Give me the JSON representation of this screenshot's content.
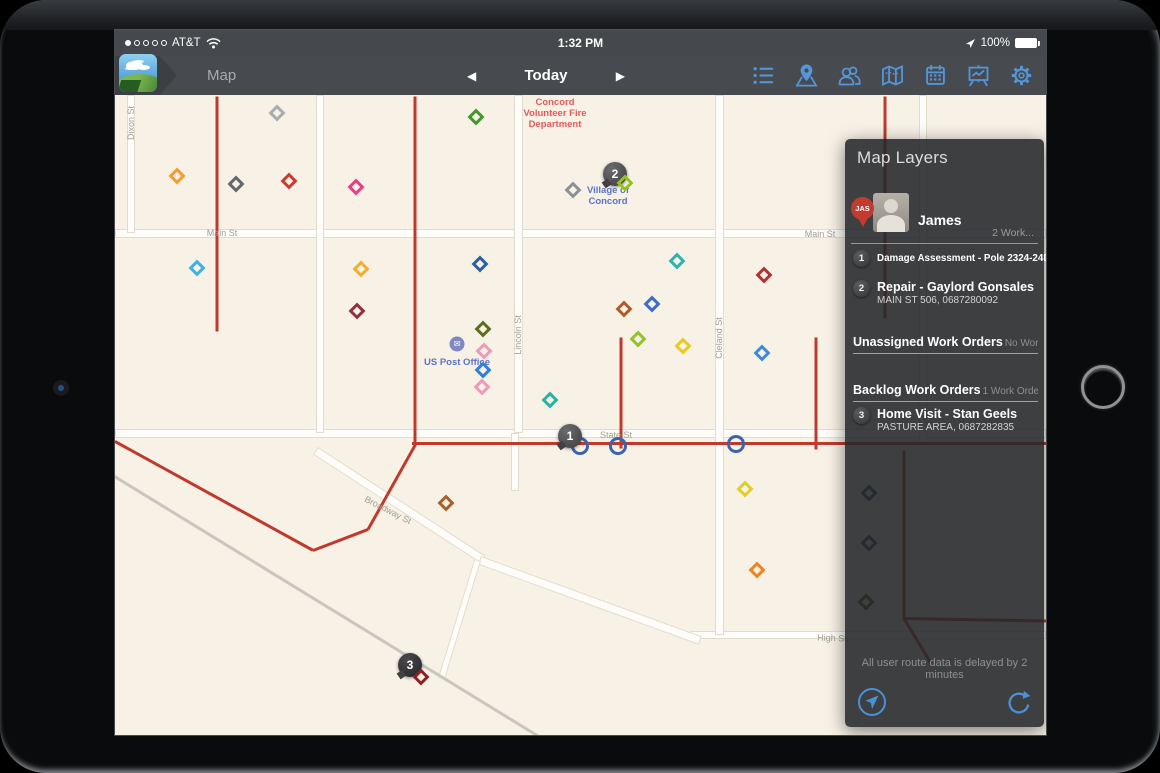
{
  "status_bar": {
    "carrier": "AT&T",
    "time": "1:32 PM",
    "battery_label": "100%",
    "icons": [
      "signal-dots",
      "wifi-icon",
      "location-arrow-icon",
      "battery-icon"
    ]
  },
  "toolbar": {
    "title": "Map",
    "today_label": "Today",
    "prev_glyph": "◀",
    "next_glyph": "▶",
    "accent_color": "#5496d9",
    "icons": [
      "list-view-icon",
      "map-pin-icon",
      "users-icon",
      "map-icon",
      "calendar-icon",
      "reports-icon",
      "settings-gear-icon"
    ]
  },
  "map": {
    "background": "#f7f1e6",
    "power_line_color": "#bf392d",
    "roads": [
      {
        "x": 0,
        "y": 134,
        "w": 931,
        "h": 9
      },
      {
        "x": 0,
        "y": 334,
        "w": 931,
        "h": 9
      },
      {
        "x": 575,
        "y": 536,
        "w": 356,
        "h": 8
      },
      {
        "x": 12,
        "y": 0,
        "w": 8,
        "h": 138
      },
      {
        "x": 201,
        "y": 0,
        "w": 8,
        "h": 338
      },
      {
        "x": 399,
        "y": 0,
        "w": 9,
        "h": 338
      },
      {
        "x": 396,
        "y": 338,
        "w": 8,
        "h": 58
      },
      {
        "x": 600,
        "y": 0,
        "w": 9,
        "h": 540
      },
      {
        "x": 804,
        "y": 0,
        "w": 8,
        "h": 348
      },
      {
        "x": 203,
        "y": 352,
        "l": 200,
        "w": 9,
        "r": 33
      },
      {
        "x": 366,
        "y": 461,
        "l": 235,
        "w": 9,
        "r": 20
      },
      {
        "x": 366,
        "y": 466,
        "l": 124,
        "w": 7,
        "r": 107
      },
      {
        "x": 0,
        "y": 380,
        "l": 520,
        "w": 3,
        "r": 31.5,
        "rail": true
      }
    ],
    "power_lines": [
      {
        "x": 102,
        "y": 0,
        "l": 235,
        "r": 90
      },
      {
        "x": 300,
        "y": 0,
        "l": 350,
        "r": 90
      },
      {
        "x": 770,
        "y": 0,
        "l": 222,
        "r": 90
      },
      {
        "x": 0,
        "y": 345,
        "l": 226,
        "r": 28.8
      },
      {
        "x": 198,
        "y": 454,
        "l": 59,
        "r": -20.9
      },
      {
        "x": 253,
        "y": 433,
        "l": 96,
        "r": -60.8
      },
      {
        "x": 297,
        "y": 347,
        "l": 634,
        "r": 0
      },
      {
        "x": 506,
        "y": 241,
        "l": 111,
        "r": 90
      },
      {
        "x": 701,
        "y": 241,
        "l": 112,
        "r": 90
      },
      {
        "x": 789,
        "y": 354,
        "l": 170,
        "r": 90
      },
      {
        "x": 789,
        "y": 522,
        "l": 142,
        "r": 1
      },
      {
        "x": 789,
        "y": 522,
        "l": 52,
        "r": 59
      }
    ],
    "street_labels": [
      {
        "t": "Dixon St",
        "x": 16,
        "y": 28,
        "r": -90
      },
      {
        "t": "Main St",
        "x": 107,
        "y": 138,
        "r": 0
      },
      {
        "t": "Main St",
        "x": 705,
        "y": 139,
        "r": 0
      },
      {
        "t": "Lincoln St",
        "x": 403,
        "y": 240,
        "r": -90
      },
      {
        "t": "Cleland St",
        "x": 604,
        "y": 243,
        "r": -90
      },
      {
        "t": "State St",
        "x": 501,
        "y": 340,
        "r": 0
      },
      {
        "t": "Broadway St",
        "x": 273,
        "y": 415,
        "r": 27
      },
      {
        "t": "High St",
        "x": 717,
        "y": 543,
        "r": 2
      }
    ],
    "poi_labels": [
      {
        "t": "Concord\nVolunteer Fire\nDepartment",
        "x": 440,
        "y": 2,
        "c": "#e25c5c"
      },
      {
        "t": "Village of\nConcord",
        "x": 493,
        "y": 90,
        "c": "#5b74c9"
      },
      {
        "t": "US Post Office",
        "x": 342,
        "y": 262,
        "c": "#5b74c9"
      }
    ],
    "post_office_icon": {
      "x": 342,
      "y": 249,
      "glyph": "✉"
    },
    "diamonds": [
      {
        "x": 162,
        "y": 18,
        "c": "#a8adb2"
      },
      {
        "x": 361,
        "y": 22,
        "c": "#43962e"
      },
      {
        "x": 62,
        "y": 81,
        "c": "#f59a2d"
      },
      {
        "x": 121,
        "y": 89,
        "c": "#64676b"
      },
      {
        "x": 174,
        "y": 86,
        "c": "#cf3832"
      },
      {
        "x": 241,
        "y": 92,
        "c": "#e63f86"
      },
      {
        "x": 458,
        "y": 95,
        "c": "#8d9196"
      },
      {
        "x": 510,
        "y": 88,
        "c": "#97c11f",
        "z": 6
      },
      {
        "x": 82,
        "y": 173,
        "c": "#3fb0ea"
      },
      {
        "x": 246,
        "y": 174,
        "c": "#f3ad2f"
      },
      {
        "x": 365,
        "y": 169,
        "c": "#2c5f9e"
      },
      {
        "x": 562,
        "y": 166,
        "c": "#2fb3ab"
      },
      {
        "x": 649,
        "y": 180,
        "c": "#b03434"
      },
      {
        "x": 242,
        "y": 216,
        "c": "#93303e"
      },
      {
        "x": 368,
        "y": 234,
        "c": "#5d6e1f"
      },
      {
        "x": 369,
        "y": 256,
        "c": "#ee9ab9"
      },
      {
        "x": 368,
        "y": 275,
        "c": "#2f7fd9"
      },
      {
        "x": 367,
        "y": 292,
        "c": "#ee9ab9"
      },
      {
        "x": 509,
        "y": 214,
        "c": "#ad5c2a"
      },
      {
        "x": 537,
        "y": 209,
        "c": "#3c6cc9"
      },
      {
        "x": 523,
        "y": 244,
        "c": "#90c32c"
      },
      {
        "x": 568,
        "y": 251,
        "c": "#e7cb21"
      },
      {
        "x": 435,
        "y": 305,
        "c": "#27b4a6"
      },
      {
        "x": 647,
        "y": 258,
        "c": "#3f8ad8"
      },
      {
        "x": 331,
        "y": 408,
        "c": "#a8602a"
      },
      {
        "x": 630,
        "y": 394,
        "c": "#e0cd2e"
      },
      {
        "x": 642,
        "y": 475,
        "c": "#f0821f"
      },
      {
        "x": 306,
        "y": 582,
        "c": "#8f2020",
        "z": 6
      },
      {
        "x": 754,
        "y": 398,
        "c": "#2c4a6e"
      },
      {
        "x": 754,
        "y": 448,
        "c": "#2c4a6e"
      },
      {
        "x": 751,
        "y": 507,
        "c": "#4c521f"
      }
    ],
    "circles": [
      {
        "x": 465,
        "y": 351
      },
      {
        "x": 503,
        "y": 351
      },
      {
        "x": 621,
        "y": 349
      }
    ],
    "badges": [
      {
        "n": "1",
        "x": 455,
        "y": 341
      },
      {
        "n": "2",
        "x": 500,
        "y": 79
      },
      {
        "n": "3",
        "x": 295,
        "y": 570,
        "dark": true
      }
    ]
  },
  "panel": {
    "title": "Map Layers",
    "user": {
      "pin_initials": "JAS",
      "name": "James",
      "count_label": "2 Work..."
    },
    "assigned": [
      {
        "n": "1",
        "title": "Damage Assessment - Pole 2324-24D7",
        "subtitle": ""
      },
      {
        "n": "2",
        "title": "Repair - Gaylord Gonsales",
        "subtitle": "MAIN ST 506, 0687280092"
      }
    ],
    "sections": [
      {
        "title": "Unassigned Work Orders",
        "meta": "No Work O..."
      },
      {
        "title": "Backlog Work Orders",
        "meta": "1 Work Order"
      }
    ],
    "backlog": [
      {
        "n": "3",
        "title": "Home Visit - Stan Geels",
        "subtitle": "PASTURE AREA, 0687282835"
      }
    ],
    "footer_note": "All user route data is delayed by 2 minutes",
    "icons": [
      "navigate-icon",
      "refresh-icon"
    ],
    "icon_color": "#4a90d9"
  }
}
